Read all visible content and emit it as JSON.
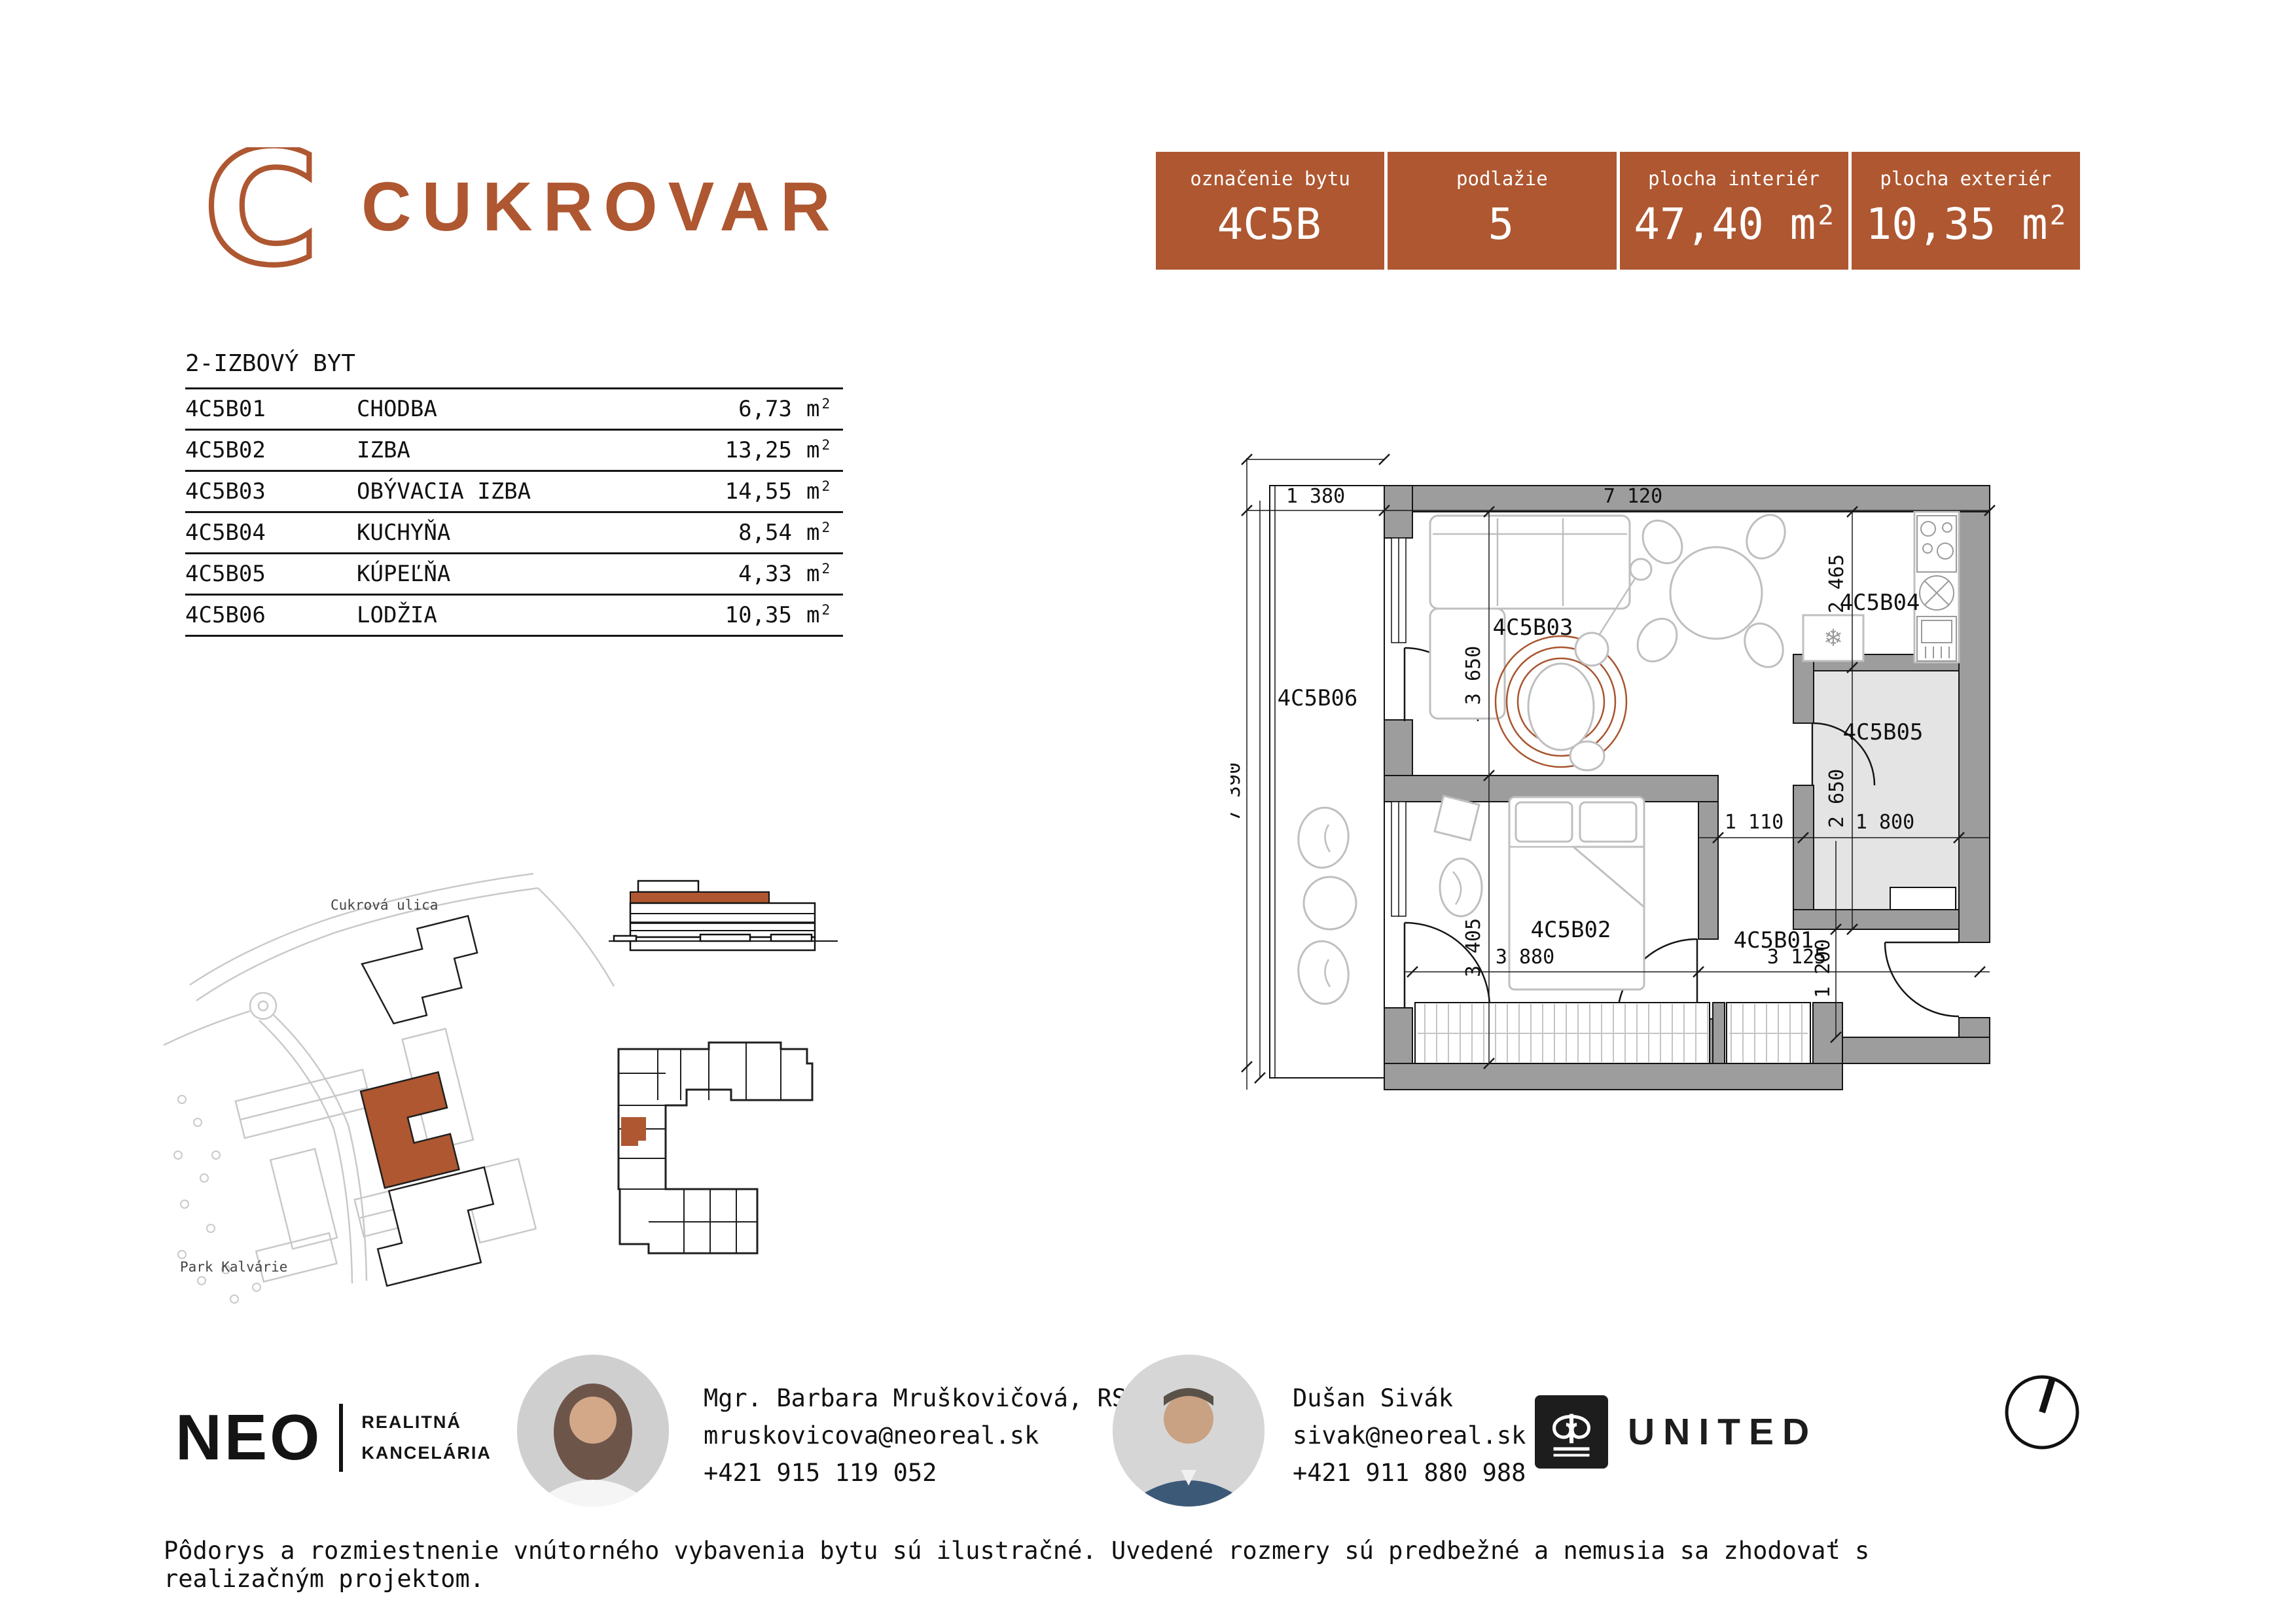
{
  "colors": {
    "accent": "#ae5731",
    "wall": "#9d9d9d",
    "furniture": "#bfbfbf",
    "rug": "#a8542e"
  },
  "brand": {
    "letter": "C",
    "name": "CUKROVAR"
  },
  "summary": {
    "cells": [
      {
        "label": "označenie bytu",
        "value": "4C5B"
      },
      {
        "label": "podlažie",
        "value": "5"
      },
      {
        "label": "plocha interiér",
        "value": "47,40",
        "unit": "m",
        "sup": "2"
      },
      {
        "label": "plocha exteriér",
        "value": "10,35",
        "unit": "m",
        "sup": "2"
      }
    ]
  },
  "rooms": {
    "title": "2-IZBOVÝ BYT",
    "unit": "m",
    "sup": "2",
    "items": [
      {
        "code": "4C5B01",
        "name": "CHODBA",
        "area": "6,73"
      },
      {
        "code": "4C5B02",
        "name": "IZBA",
        "area": "13,25"
      },
      {
        "code": "4C5B03",
        "name": "OBÝVACIA IZBA",
        "area": "14,55"
      },
      {
        "code": "4C5B04",
        "name": "KUCHYŇA",
        "area": "8,54"
      },
      {
        "code": "4C5B05",
        "name": "KÚPEĽŇA",
        "area": "4,33"
      },
      {
        "code": "4C5B06",
        "name": "LODŽIA",
        "area": "10,35"
      }
    ]
  },
  "plan": {
    "rooms": {
      "hall": "4C5B01",
      "bedroom": "4C5B02",
      "living": "4C5B03",
      "kitchen": "4C5B04",
      "bath": "4C5B05",
      "loggia": "4C5B06"
    },
    "dims": {
      "w_loggia": "1 380",
      "w_total": "7 120",
      "h_total": "7 390",
      "h_living": "3 650",
      "h_kitchen": "2 465",
      "h_bath": "2 650",
      "w_hall1": "1 110",
      "w_bath": "1 800",
      "h_bedroom": "3 405",
      "w_bedroom": "3 880",
      "w_hall2": "3 125",
      "h_entry": "1 200"
    },
    "icons": {
      "fridge_snowflake": "❄"
    }
  },
  "map": {
    "street": "Cukrová ulica",
    "park": "Park Kalvárie"
  },
  "agency": {
    "name": "NEO",
    "tag1": "REALITNÁ",
    "tag2": "KANCELÁRIA"
  },
  "contacts": [
    {
      "name": "Mgr. Barbara Mruškovičová, RSc.",
      "email": "mruskovicova@neoreal.sk",
      "phone": "+421 915 119 052"
    },
    {
      "name": "Dušan Sivák",
      "email": "sivak@neoreal.sk",
      "phone": "+421 911 880 988"
    }
  ],
  "developer": {
    "name": "UNITED"
  },
  "disclaimer": "Pôdorys a rozmiestnenie vnútorného vybavenia bytu sú ilustračné. Uvedené rozmery sú predbežné a nemusia sa zhodovať s realizačným projektom."
}
